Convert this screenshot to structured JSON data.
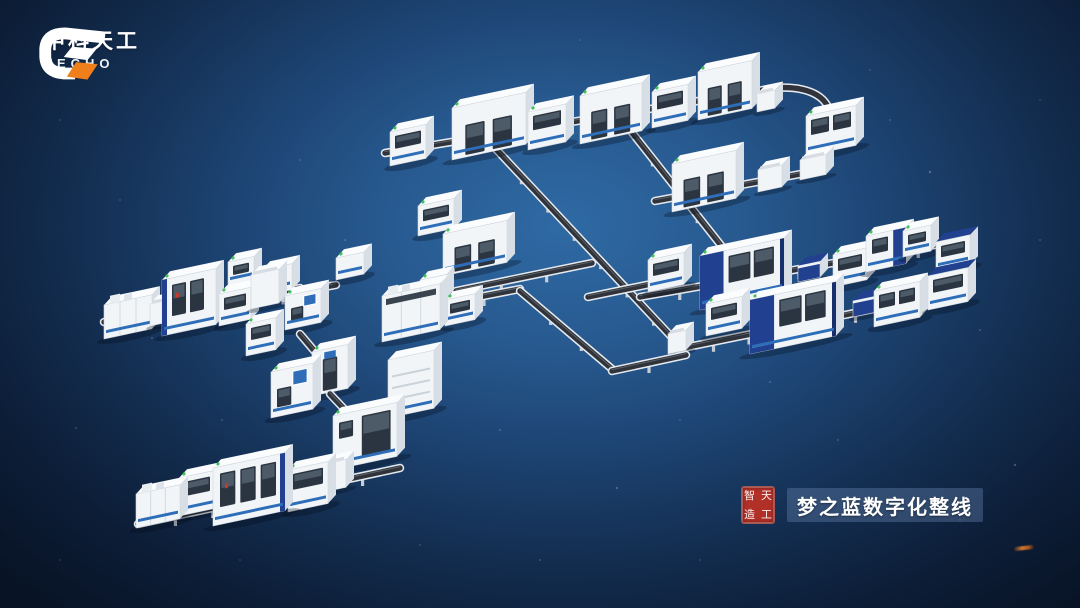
{
  "brand": {
    "name_cn": "中科天工",
    "name_en": "TECHO",
    "mark_orange": "#ef7f1a",
    "mark_white": "#ffffff"
  },
  "caption": {
    "label": "梦之蓝数字化整线",
    "seal_chars": [
      "智",
      "天",
      "造",
      "工"
    ],
    "seal_color": "#b13028",
    "bar_color": "rgba(104,134,178,0.38)"
  },
  "background": {
    "center": "#2f6aa4",
    "mid": "#1c4270",
    "edge": "#081325"
  },
  "palette": {
    "front": "#f2f5f8",
    "side": "#d8dee5",
    "roof": "#fbfcfd",
    "edge": "#cfd6dd",
    "window": "#2b3541",
    "windowInner": "#4d5a67",
    "stripe": "#2e6db8",
    "navy": "#21408f",
    "navyDark": "#182f6e",
    "screen": "#2f6db8",
    "belt": "#30343a",
    "beltLight": "#e4e9ef",
    "beltMid": "#5a6069",
    "feet": "#c6cdd5",
    "green": "#3ec257",
    "red": "#c03a2e",
    "shadow": "rgba(4,10,22,0.3)",
    "panelSeam": "#d3dae1",
    "vent": "#c9d1d9",
    "topBox": "#e8edf2"
  },
  "scene": {
    "items": [
      {
        "e": [
          385,
          153,
          758,
          91
        ]
      },
      {
        "c": "M758,91 C792,83 818,90 827,105 L833,124"
      },
      {
        "s": [
          630,
          130,
          742,
          272
        ]
      },
      {
        "s": [
          495,
          148,
          680,
          346
        ]
      },
      {
        "e": [
          655,
          201,
          806,
          173
        ]
      },
      {
        "m": [
          390,
          166,
          36,
          34,
          "win"
        ]
      },
      {
        "m": [
          452,
          160,
          74,
          52,
          "door2"
        ]
      },
      {
        "m": [
          528,
          150,
          38,
          38,
          "win"
        ]
      },
      {
        "m": [
          580,
          144,
          62,
          48,
          "door2"
        ]
      },
      {
        "m": [
          652,
          128,
          36,
          36,
          "win"
        ]
      },
      {
        "m": [
          698,
          120,
          54,
          48,
          "door2"
        ]
      },
      {
        "m": [
          757,
          112,
          18,
          18,
          "stand"
        ]
      },
      {
        "m": [
          806,
          156,
          50,
          40,
          "win"
        ]
      },
      {
        "m": [
          800,
          180,
          26,
          20,
          "stand"
        ]
      },
      {
        "m": [
          672,
          212,
          64,
          48,
          "door2"
        ]
      },
      {
        "m": [
          758,
          192,
          24,
          22,
          "stand"
        ]
      },
      {
        "e": [
          588,
          297,
          656,
          283
        ]
      },
      {
        "e": [
          640,
          297,
          958,
          241
        ]
      },
      {
        "e": [
          678,
          349,
          962,
          291
        ]
      },
      {
        "m": [
          668,
          354,
          18,
          20,
          "stand"
        ]
      },
      {
        "m": [
          648,
          292,
          36,
          32,
          "win"
        ]
      },
      {
        "m": [
          700,
          310,
          84,
          54,
          "blue"
        ]
      },
      {
        "m": [
          798,
          282,
          22,
          16,
          "cart"
        ]
      },
      {
        "m": [
          833,
          287,
          34,
          32,
          "win"
        ]
      },
      {
        "m": [
          866,
          272,
          40,
          36,
          "blueAcc"
        ]
      },
      {
        "m": [
          903,
          257,
          28,
          26,
          "win"
        ]
      },
      {
        "m": [
          936,
          272,
          34,
          30,
          "blueTop"
        ]
      },
      {
        "m": [
          706,
          336,
          36,
          32,
          "win"
        ]
      },
      {
        "m": [
          750,
          354,
          86,
          54,
          "blue"
        ]
      },
      {
        "m": [
          853,
          317,
          22,
          16,
          "cart"
        ]
      },
      {
        "m": [
          874,
          327,
          46,
          36,
          "win"
        ]
      },
      {
        "m": [
          928,
          310,
          40,
          34,
          "blueTop"
        ]
      },
      {
        "e": [
          104,
          322,
          300,
          288
        ]
      },
      {
        "e": [
          230,
          304,
          336,
          285
        ]
      },
      {
        "m": [
          228,
          286,
          26,
          24,
          "win"
        ]
      },
      {
        "m": [
          262,
          296,
          30,
          26,
          "win"
        ]
      },
      {
        "m": [
          336,
          280,
          28,
          22,
          "plain"
        ]
      },
      {
        "m": [
          418,
          236,
          36,
          30,
          "win"
        ]
      },
      {
        "m": [
          443,
          276,
          64,
          42,
          "door2"
        ]
      },
      {
        "e": [
          456,
          291,
          592,
          263
        ]
      },
      {
        "e": [
          448,
          303,
          520,
          289
        ]
      },
      {
        "s": [
          520,
          291,
          612,
          369
        ]
      },
      {
        "e": [
          612,
          371,
          686,
          355
        ]
      },
      {
        "m": [
          420,
          304,
          26,
          24,
          "win"
        ]
      },
      {
        "m": [
          445,
          326,
          30,
          26,
          "win"
        ]
      },
      {
        "m": [
          104,
          339,
          48,
          34,
          "panel"
        ]
      },
      {
        "m": [
          150,
          326,
          18,
          22,
          "stand"
        ]
      },
      {
        "m": [
          162,
          336,
          54,
          56,
          "big2"
        ]
      },
      {
        "m": [
          219,
          326,
          32,
          32,
          "win"
        ]
      },
      {
        "m": [
          251,
          309,
          28,
          34,
          "stand"
        ]
      },
      {
        "m": [
          285,
          330,
          36,
          34,
          "screen"
        ]
      },
      {
        "m": [
          246,
          356,
          30,
          32,
          "win"
        ]
      },
      {
        "m": [
          382,
          342,
          58,
          46,
          "panel2"
        ]
      },
      {
        "s": [
          300,
          334,
          322,
          360
        ]
      },
      {
        "m": [
          312,
          396,
          36,
          44,
          "tallscreen"
        ]
      },
      {
        "s": [
          330,
          394,
          364,
          430
        ]
      },
      {
        "m": [
          271,
          418,
          42,
          46,
          "screen"
        ]
      },
      {
        "m": [
          388,
          418,
          46,
          58,
          "vents"
        ]
      },
      {
        "e": [
          138,
          524,
          400,
          468
        ]
      },
      {
        "m": [
          333,
          470,
          64,
          54,
          "bigdoor"
        ]
      },
      {
        "m": [
          324,
          492,
          22,
          28,
          "stand"
        ]
      },
      {
        "m": [
          286,
          504,
          18,
          22,
          "stand"
        ]
      },
      {
        "m": [
          220,
          507,
          14,
          28,
          "stand"
        ]
      },
      {
        "m": [
          288,
          512,
          40,
          42,
          "win"
        ]
      },
      {
        "m": [
          179,
          516,
          36,
          38,
          "win"
        ]
      },
      {
        "m": [
          213,
          526,
          72,
          58,
          "big3"
        ]
      },
      {
        "m": [
          136,
          528,
          44,
          34,
          "panel"
        ]
      }
    ],
    "stars": [
      [
        152,
        338,
        1,
        0.22
      ],
      [
        76,
        428,
        1,
        0.18
      ],
      [
        345,
        240,
        1,
        0.2
      ],
      [
        408,
        312,
        1.2,
        0.25
      ],
      [
        300,
        160,
        1,
        0.15
      ],
      [
        222,
        420,
        1,
        0.18
      ],
      [
        500,
        430,
        1,
        0.2
      ],
      [
        617,
        488,
        1.2,
        0.22
      ],
      [
        680,
        420,
        1,
        0.15
      ],
      [
        770,
        382,
        1,
        0.2
      ],
      [
        838,
        440,
        1,
        0.18
      ],
      [
        930,
        172,
        1.2,
        0.25
      ],
      [
        890,
        120,
        1,
        0.18
      ],
      [
        980,
        330,
        1,
        0.2
      ],
      [
        1015,
        465,
        1.2,
        0.22
      ],
      [
        540,
        560,
        1,
        0.18
      ],
      [
        420,
        545,
        1,
        0.15
      ],
      [
        120,
        200,
        1,
        0.15
      ],
      [
        60,
        120,
        1,
        0.12
      ],
      [
        700,
        560,
        1,
        0.15
      ],
      [
        960,
        520,
        1,
        0.15
      ],
      [
        1040,
        240,
        1,
        0.18
      ],
      [
        870,
        70,
        1,
        0.15
      ],
      [
        240,
        560,
        1,
        0.12
      ],
      [
        580,
        40,
        1,
        0.12
      ],
      [
        60,
        560,
        1,
        0.12
      ],
      [
        1040,
        100,
        1,
        0.12
      ]
    ]
  }
}
